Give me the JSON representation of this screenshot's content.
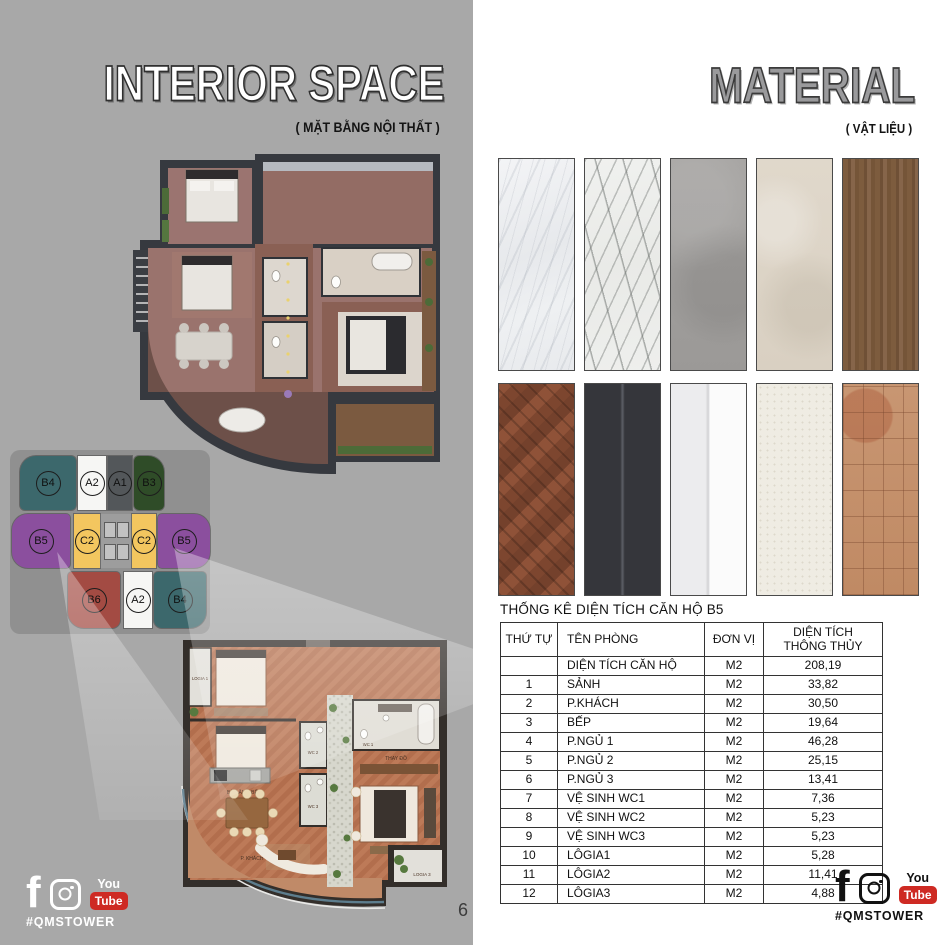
{
  "page": {
    "number": "6"
  },
  "interior_section": {
    "title": "INTERIOR SPACE",
    "subtitle": "( MẶT BẰNG NỘI THẤT )"
  },
  "material_section": {
    "title": "MATERIAL",
    "subtitle": "( VẬT LIỆU )"
  },
  "key_plan": {
    "highlighted_unit": "B5",
    "units": [
      {
        "label": "B4",
        "color": "#3c686c"
      },
      {
        "label": "A2",
        "color": "#f6f6f4"
      },
      {
        "label": "A1",
        "color": "#53575a"
      },
      {
        "label": "B3",
        "color": "#2f4c28"
      },
      {
        "label": "B5",
        "color": "#8b4f9e"
      },
      {
        "label": "C2",
        "color": "#f3c65f"
      },
      {
        "label": "C2",
        "color": "#f3c65f"
      },
      {
        "label": "B5",
        "color": "#8b4f9e"
      },
      {
        "label": "B6",
        "color": "#a34b43"
      },
      {
        "label": "A2",
        "color": "#f6f6f4"
      },
      {
        "label": "B4",
        "color": "#3c686c"
      }
    ]
  },
  "floor_plans": {
    "lower_labels": [
      "LOGIA 1",
      "WC 1",
      "WC 2",
      "WC 3",
      "BÀN ĂN + BẾP",
      "P. KHÁCH",
      "THAY ĐỒ",
      "LOGIA 3"
    ]
  },
  "materials": {
    "swatches": [
      {
        "name": "white-marble-light"
      },
      {
        "name": "white-marble-veined"
      },
      {
        "name": "gray-concrete"
      },
      {
        "name": "beige-travertine"
      },
      {
        "name": "walnut-wood"
      },
      {
        "name": "herringbone-parquet"
      },
      {
        "name": "charcoal-panel"
      },
      {
        "name": "white-gloss-panel"
      },
      {
        "name": "cream-stucco"
      },
      {
        "name": "terracotta-mosaic"
      }
    ]
  },
  "area_table": {
    "title": "THỐNG KÊ DIỆN TÍCH CĂN HỘ B5",
    "headers": [
      [
        "THỨ TỰ"
      ],
      [
        "TÊN PHÒNG"
      ],
      [
        "ĐƠN VỊ"
      ],
      [
        "DIỆN TÍCH",
        "THÔNG THỦY"
      ]
    ],
    "rows": [
      [
        "",
        "DIỆN TÍCH CĂN HỘ",
        "M2",
        "208,19"
      ],
      [
        "1",
        "SẢNH",
        "M2",
        "33,82"
      ],
      [
        "2",
        "P.KHÁCH",
        "M2",
        "30,50"
      ],
      [
        "3",
        "BẾP",
        "M2",
        "19,64"
      ],
      [
        "4",
        "P.NGỦ 1",
        "M2",
        "46,28"
      ],
      [
        "5",
        "P.NGỦ 2",
        "M2",
        "25,15"
      ],
      [
        "6",
        "P.NGỦ 3",
        "M2",
        "13,41"
      ],
      [
        "7",
        "VỆ SINH WC1",
        "M2",
        "7,36"
      ],
      [
        "8",
        "VỆ SINH WC2",
        "M2",
        "5,23"
      ],
      [
        "9",
        "VỆ SINH WC3",
        "M2",
        "5,23"
      ],
      [
        "10",
        "LÔGIA1",
        "M2",
        "5,28"
      ],
      [
        "11",
        "LÔGIA2",
        "M2",
        "11,41"
      ],
      [
        "12",
        "LÔGIA3",
        "M2",
        "4,88"
      ]
    ]
  },
  "social": {
    "hashtag": "#QMSTOWER",
    "youtube_you": "You",
    "youtube_tube": "Tube",
    "youtube_red": "#ce2a23"
  },
  "colors": {
    "left_background": "#a8a8a8",
    "right_background": "#ffffff"
  }
}
